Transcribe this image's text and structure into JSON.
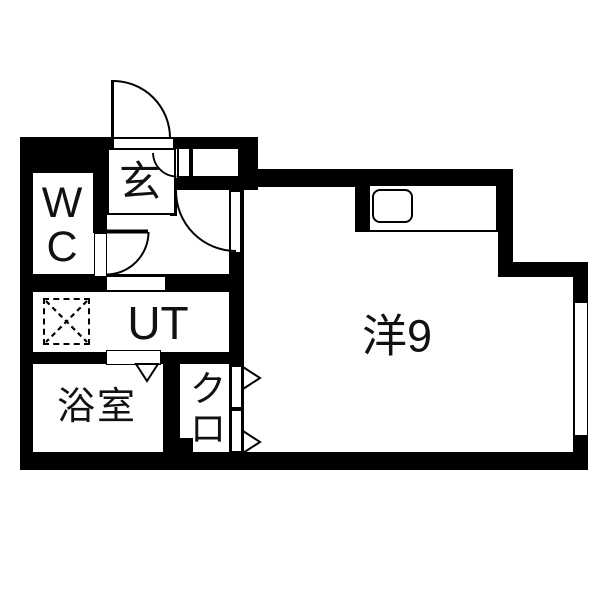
{
  "floorplan": {
    "type": "japanese-apartment-floorplan",
    "colors": {
      "wall": "#000000",
      "floor": "#ffffff",
      "line": "#000000"
    },
    "rooms": {
      "entrance": {
        "label": "玄"
      },
      "wc": {
        "lines": [
          "W",
          "C"
        ]
      },
      "utility": {
        "label": "UT"
      },
      "bathroom": {
        "label": "浴室"
      },
      "closet": {
        "chars": [
          "ク",
          "ロ"
        ]
      },
      "western_room": {
        "label": "洋9"
      }
    },
    "symbols": [
      "entrance-door-swing-arc",
      "hall-door-swing-arc",
      "wc-door-swing-arc",
      "storage-door-swing-arc",
      "bath-folding-door-triangle",
      "closet-door-triangles",
      "washing-machine-dashed-box",
      "kitchen-sink",
      "window-right-wall"
    ]
  }
}
